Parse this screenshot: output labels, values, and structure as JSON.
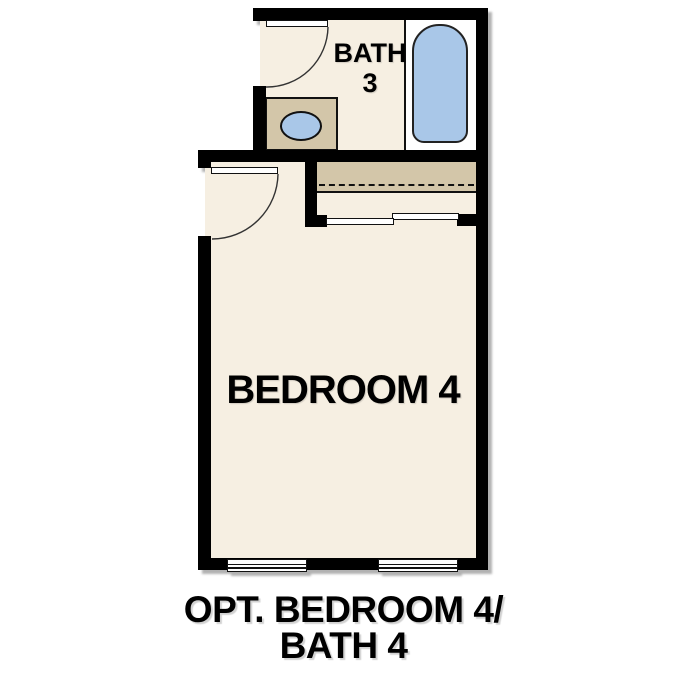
{
  "plan": {
    "caption": {
      "line1": "OPT. BEDROOM 4/",
      "line2": "BATH 4"
    },
    "rooms": {
      "bath": {
        "name_line1": "BATH",
        "name_line2": "3"
      },
      "bedroom": {
        "name": "BEDROOM 4"
      }
    },
    "fixtures": [
      "bathtub",
      "vanity-counter",
      "sink",
      "closet-shelf",
      "closet-hanging-rod",
      "swing-door-bath",
      "swing-door-bedroom",
      "bypass-closet-doors",
      "window-left",
      "window-right"
    ],
    "colors": {
      "wall": "#000000",
      "floor": "#f6efe2",
      "counter": "#d3c6a9",
      "fixture_blue": "#a9c7e8",
      "background": "#ffffff"
    }
  }
}
